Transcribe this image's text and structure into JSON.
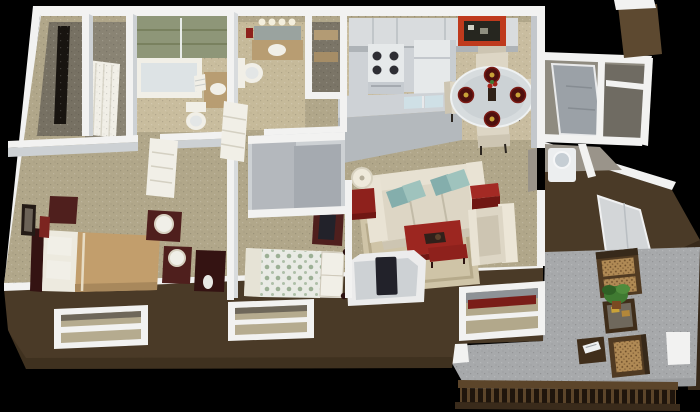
{
  "scene": {
    "description": "3D isometric rendering of a one-story apartment floor plan with furnished rooms and a rear patio on a black background",
    "style": "3d-floorplan-render"
  },
  "colors": {
    "bg": "#000000",
    "wall_top": "#f2f2f1",
    "wall_face": "#cdd1d4",
    "wall_shadow": "#9aa0a5",
    "ext_brown": "#4a3a27",
    "ext_brown_dark": "#37291a",
    "ext_brown_light": "#5d4930",
    "carpet": "#b1a78a",
    "carpet_dark": "#99907a",
    "vinyl": "#c9bda0",
    "tile_green": "#8e9678",
    "patio_floor": "#a7a9ab",
    "patio_floor_dark": "#97999b",
    "mahogany": "#4f1f1d",
    "mahogany_dark": "#341312",
    "red_accent": "#8e211c",
    "red_bright": "#a32a24",
    "red_dark": "#701713",
    "teal_a": "#84aeac",
    "teal_b": "#9fc3bd",
    "cream": "#ddd6c5",
    "cream_light": "#e9e3d4",
    "cream_dark": "#cdc5b2",
    "tan_bed": "#c29e6c",
    "white_soft": "#f1efe7",
    "appliance": "#e6e9ea",
    "counter": "#b4b9bd",
    "counter_light": "#ced2d6",
    "sink_blue": "#cfe0e6",
    "door_gray": "#9ba1a7",
    "wicker_frame": "#503a22",
    "wicker_cushion": "#b08a55",
    "plant_green": "#3f7a31",
    "glass": "#d7dcde",
    "tv_dark": "#22222a",
    "closet_floor": "#777163",
    "rug": "#cfc4a7",
    "railing_dark": "#1f150c",
    "rail_wood": "#5c452a"
  },
  "rooms": [
    {
      "name": "bedroom-1",
      "furniture": [
        "bed with tan comforter",
        "headboard",
        "nightstands",
        "lamps",
        "dresser",
        "wall art",
        "red vase"
      ]
    },
    {
      "name": "bedroom-2",
      "furniture": [
        "bed with polka-dot comforter",
        "dresser with tv",
        "sliding-door closet"
      ]
    },
    {
      "name": "master-bathroom",
      "furniture": [
        "glass shower over tub",
        "green tile surround",
        "vanity sink",
        "toilet",
        "towels"
      ]
    },
    {
      "name": "hall-bathroom",
      "furniture": [
        "vanity with lights",
        "sink",
        "toilet"
      ]
    },
    {
      "name": "walk-in-closet",
      "furniture": [
        "clothes rod",
        "leaning door"
      ]
    },
    {
      "name": "linen-closet",
      "furniture": [
        "shelves"
      ]
    },
    {
      "name": "kitchen",
      "furniture": [
        "upper cabinets",
        "range with burners",
        "refrigerator",
        "bar counter",
        "double sink"
      ]
    },
    {
      "name": "dining-area",
      "furniture": [
        "round glass table",
        "four cream chairs",
        "four place settings",
        "red wall art"
      ]
    },
    {
      "name": "living-room",
      "furniture": [
        "cream sofa",
        "teal pillows",
        "armchair",
        "red ottoman cube",
        "red coffee table",
        "red side table with lamp",
        "area rug",
        "media niche with tv",
        "red console",
        "patio window"
      ]
    },
    {
      "name": "entry",
      "furniture": [
        "front door",
        "coat closet with shelf"
      ]
    },
    {
      "name": "laundry-closet",
      "furniture": [
        "washer"
      ]
    },
    {
      "name": "patio",
      "furniture": [
        "wicker loveseat",
        "wicker chair",
        "coffee table with plant",
        "side table with magazine",
        "railing with balusters",
        "white posts",
        "patio door"
      ]
    }
  ]
}
